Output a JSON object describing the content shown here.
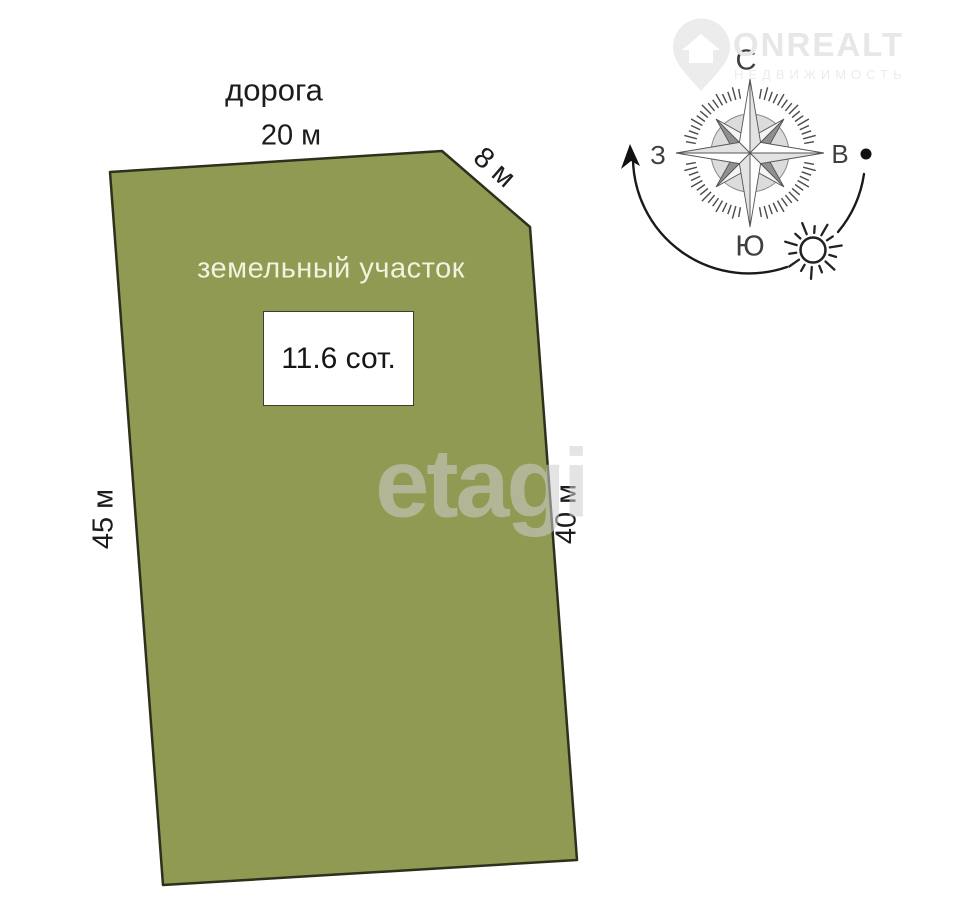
{
  "page": {
    "background_color": "#ffffff"
  },
  "branding": {
    "logo_text": "ONREALT",
    "logo_subtext": "НЕДВИЖИМОСТЬ",
    "watermark_text": "etagi"
  },
  "plot": {
    "title": "земельный участок",
    "area_label": "11.6 сот.",
    "road_label": "дорога",
    "fill_color": "#919A52",
    "outline_color": "#2E2F1D",
    "dimensions": {
      "top": "20 м",
      "top_right_diagonal": "8 м",
      "left": "45 м",
      "right": "40 м"
    }
  },
  "compass": {
    "north": "С",
    "south": "Ю",
    "west": "З",
    "east": "В"
  },
  "icons": {
    "compass_rose": "compass-rose-icon",
    "sun": "sun-icon",
    "sun_path": "sun-path-arc",
    "location_pin": "location-pin-icon"
  }
}
